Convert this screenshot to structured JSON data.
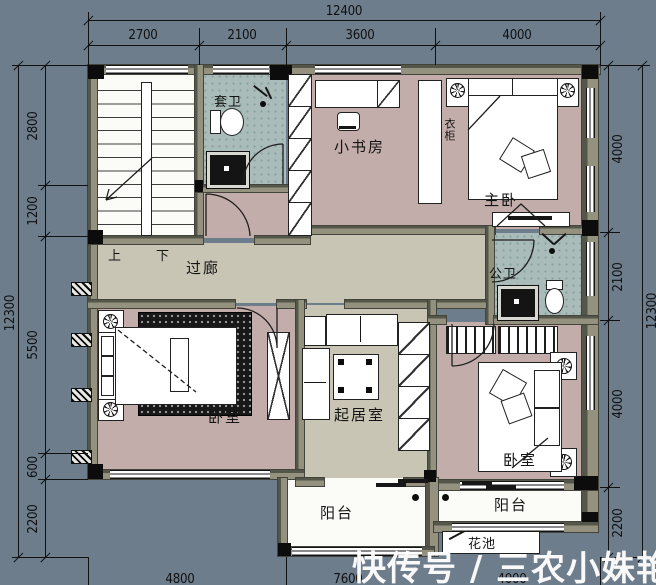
{
  "watermark": "快传号 / 三农小姝艳",
  "dimensions": {
    "top": {
      "total": "12400",
      "segments": [
        "2700",
        "2100",
        "3600",
        "4000"
      ]
    },
    "left": {
      "total": "12300",
      "segments": [
        "2800",
        "1200",
        "5500",
        "600",
        "2200"
      ]
    },
    "right": {
      "total": "12300",
      "segments": [
        "4000",
        "2100",
        "4000",
        "2200"
      ]
    },
    "bottom": {
      "segments": [
        "4800",
        "7600",
        "4000"
      ]
    }
  },
  "rooms": {
    "ensuite_bath": "套卫",
    "study": "小书房",
    "master_bedroom": "主卧",
    "corridor": "过廊",
    "public_bath": "公卫",
    "bedroom_left": "卧室",
    "living_room": "起居室",
    "bedroom_right": "卧室",
    "balcony_left": "阳台",
    "balcony_right": "阳台",
    "flower_bed": "花池",
    "wardrobe_label": "衣柜"
  },
  "stairs": {
    "up": "上",
    "down": "下"
  },
  "colors": {
    "background": "#6d7d8c",
    "wall_dark": "#55564a",
    "wall_light": "#94917f",
    "floor_bedroom": "#c2adaa",
    "floor_bath": "#a9bcb9",
    "floor_hall": "#c9c5b5",
    "floor_white": "#fbfbf8",
    "column": "#0c0c0c",
    "dim_text": "#101010",
    "watermark": "#ffffff"
  }
}
